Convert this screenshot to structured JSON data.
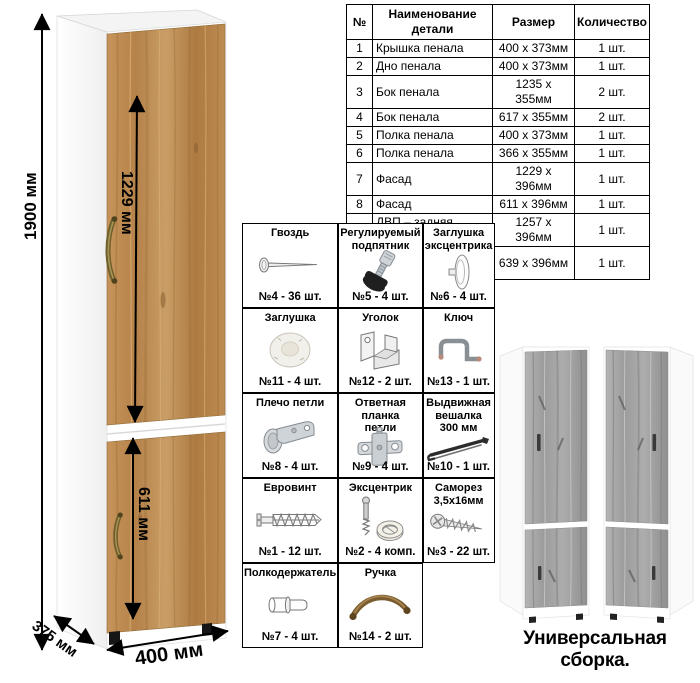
{
  "dimensions": {
    "height_label": "1900 мм",
    "upper_door_label": "1229 мм",
    "lower_door_label": "611 мм",
    "width_label": "400 мм",
    "depth_label": "375 мм"
  },
  "parts_table": {
    "headers": [
      "№",
      "Наименование детали",
      "Размер",
      "Количество"
    ],
    "rows": [
      {
        "num": "1",
        "name": "Крышка пенала",
        "size": "400 х 373мм",
        "qty": "1 шт."
      },
      {
        "num": "2",
        "name": "Дно пенала",
        "size": "400 х 373мм",
        "qty": "1 шт."
      },
      {
        "num": "3",
        "name": "Бок пенала",
        "size": "1235 х 355мм",
        "qty": "2 шт."
      },
      {
        "num": "4",
        "name": "Бок пенала",
        "size": "617 х 355мм",
        "qty": "2 шт."
      },
      {
        "num": "5",
        "name": "Полка пенала",
        "size": "400 х 373мм",
        "qty": "1 шт."
      },
      {
        "num": "6",
        "name": "Полка пенала",
        "size": "366 х 355мм",
        "qty": "1 шт."
      },
      {
        "num": "7",
        "name": "Фасад",
        "size": "1229 х 396мм",
        "qty": "1 шт."
      },
      {
        "num": "8",
        "name": "Фасад",
        "size": "611 х 396мм",
        "qty": "1 шт."
      },
      {
        "num": "9",
        "name": "ДВП – задняя стенка пенала",
        "size": "1257 х 396мм",
        "qty": "1 шт."
      },
      {
        "num": "10",
        "name": "ДВП – задняя стенка пенала",
        "size": "639 х 396мм",
        "qty": "1 шт."
      }
    ]
  },
  "hardware": {
    "items": [
      {
        "title": "Гвоздь",
        "qty": "№4 - 36 шт.",
        "icon": "nail-icon"
      },
      {
        "title": "Регулируемый\nподпятник",
        "qty": "№5 - 4 шт.",
        "icon": "adjustable-foot-icon"
      },
      {
        "title": "Заглушка\nэксцентрика",
        "qty": "№6 - 4 шт.",
        "icon": "cam-cover-icon"
      },
      {
        "title": "Заглушка",
        "qty": "№11 - 4 шт.",
        "icon": "plug-cap-icon"
      },
      {
        "title": "Уголок",
        "qty": "№12 - 2 шт.",
        "icon": "corner-bracket-icon"
      },
      {
        "title": "Ключ",
        "qty": "№13 - 1 шт.",
        "icon": "hex-key-icon"
      },
      {
        "title": "Плечо петли",
        "qty": "№8 - 4 шт.",
        "icon": "hinge-arm-icon"
      },
      {
        "title": "Ответная планка\nпетли",
        "qty": "№9 - 4 шт.",
        "icon": "hinge-plate-icon"
      },
      {
        "title": "Выдвижная\nвешалка\n300 мм",
        "qty": "№10 - 1 шт.",
        "icon": "pullout-hanger-icon"
      },
      {
        "title": "Евровинт",
        "qty": "№1 - 12 шт.",
        "icon": "euro-screw-icon"
      },
      {
        "title": "Эксцентрик",
        "qty": "№2 - 4 комп.",
        "icon": "cam-lock-icon"
      },
      {
        "title": "Саморез\n3,5х16мм",
        "qty": "№3 - 22 шт.",
        "icon": "self-tapping-screw-icon"
      },
      {
        "title": "Полкодержатель",
        "qty": "№7 - 4 шт.",
        "icon": "shelf-pin-icon"
      },
      {
        "title": "Ручка",
        "qty": "№14 - 2 шт.",
        "icon": "handle-icon"
      }
    ]
  },
  "footer": {
    "caption": "Универсальная сборка."
  },
  "colors": {
    "wood": "#c0904f",
    "wood_dark": "#9c6c35",
    "gray_wood": "#a2a2a2",
    "handle_bronze": "#77652c",
    "line_black": "#000000"
  }
}
